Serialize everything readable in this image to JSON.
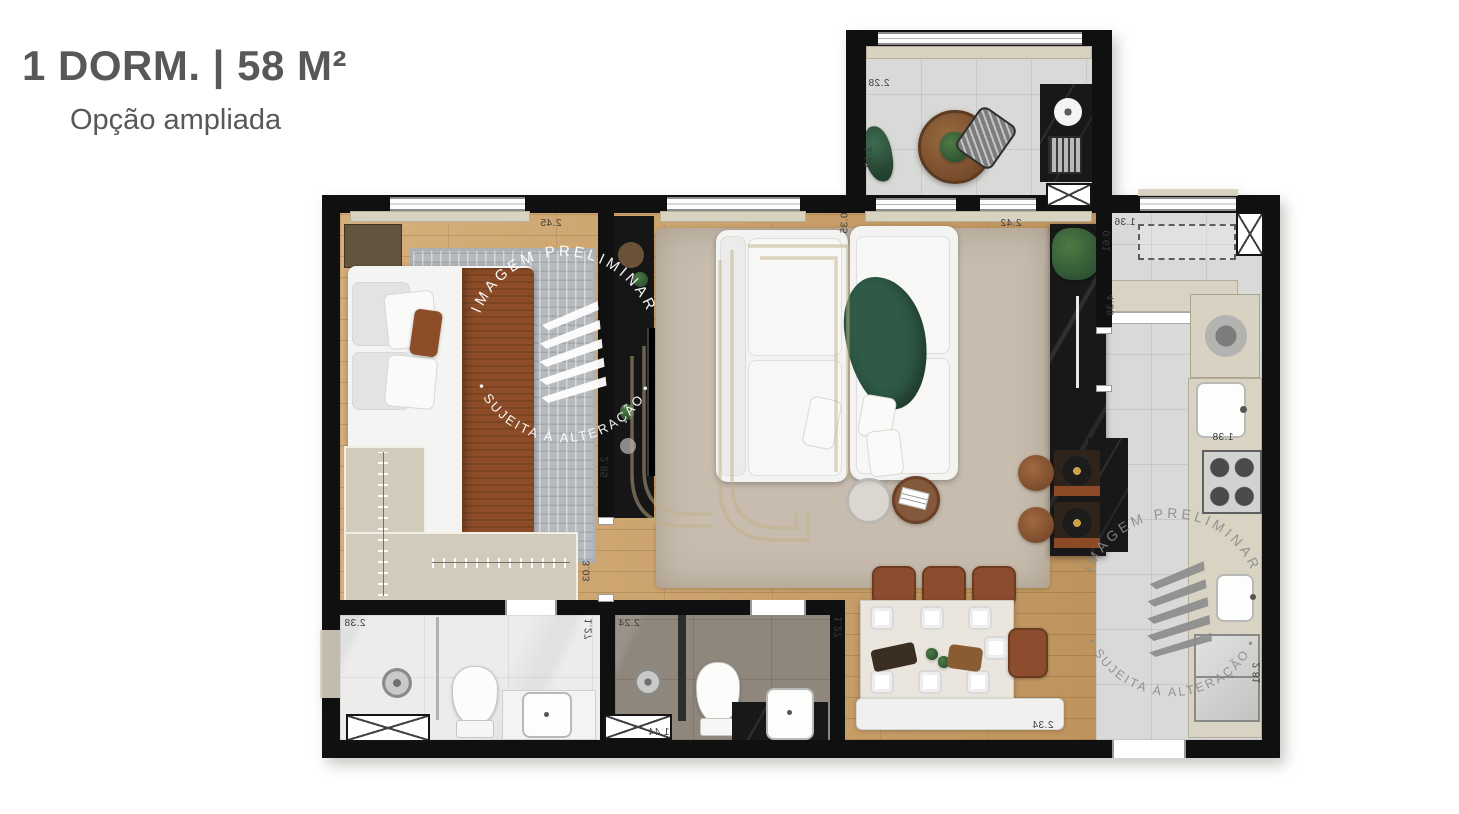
{
  "header": {
    "title": "1 DORM. | 58 M²",
    "subtitle": "Opção ampliada"
  },
  "watermarks": {
    "primary": {
      "arc_top": "IMAGEM PRELIMINAR",
      "arc_bottom": "• SUJEITA À ALTERAÇÃO •"
    },
    "secondary": {
      "arc_top": "IMAGEM PRELIMINAR",
      "arc_bottom": "• SUJEITA À ALTERAÇÃO •"
    }
  },
  "dimensions": [
    {
      "room": "balcony",
      "value": "2.28"
    },
    {
      "room": "balcony",
      "value": "1.19"
    },
    {
      "room": "bedroom",
      "value": "2.45"
    },
    {
      "room": "living",
      "value": "0.35"
    },
    {
      "room": "living",
      "value": "2.42"
    },
    {
      "room": "living",
      "value": "2.85"
    },
    {
      "room": "hall",
      "value": "3.03"
    },
    {
      "room": "laundry",
      "value": "1.36"
    },
    {
      "room": "laundry",
      "value": "0.61"
    },
    {
      "room": "kitchen",
      "value": "4.38"
    },
    {
      "room": "kitchen",
      "value": "1.38"
    },
    {
      "room": "kitchen",
      "value": "2.81"
    },
    {
      "room": "bathroom-1",
      "value": "2.38"
    },
    {
      "room": "bathroom-1",
      "value": "1.27"
    },
    {
      "room": "bathroom-2",
      "value": "2.24"
    },
    {
      "room": "bathroom-2",
      "value": "1.27"
    },
    {
      "room": "bathroom-2",
      "value": "1.44"
    },
    {
      "room": "dining",
      "value": "2.34"
    }
  ],
  "colors": {
    "title_text": "#57585a",
    "wall": "#101010",
    "wood_floor": "#c99f68",
    "tile_floor": "#d9d9d7",
    "brand_gold": "#c2b189",
    "watermark_primary": "#ffffff",
    "watermark_secondary": "#8b8b8b",
    "bed_blanket": "#8c4d28",
    "sofa_throw": "#2f5a47"
  }
}
